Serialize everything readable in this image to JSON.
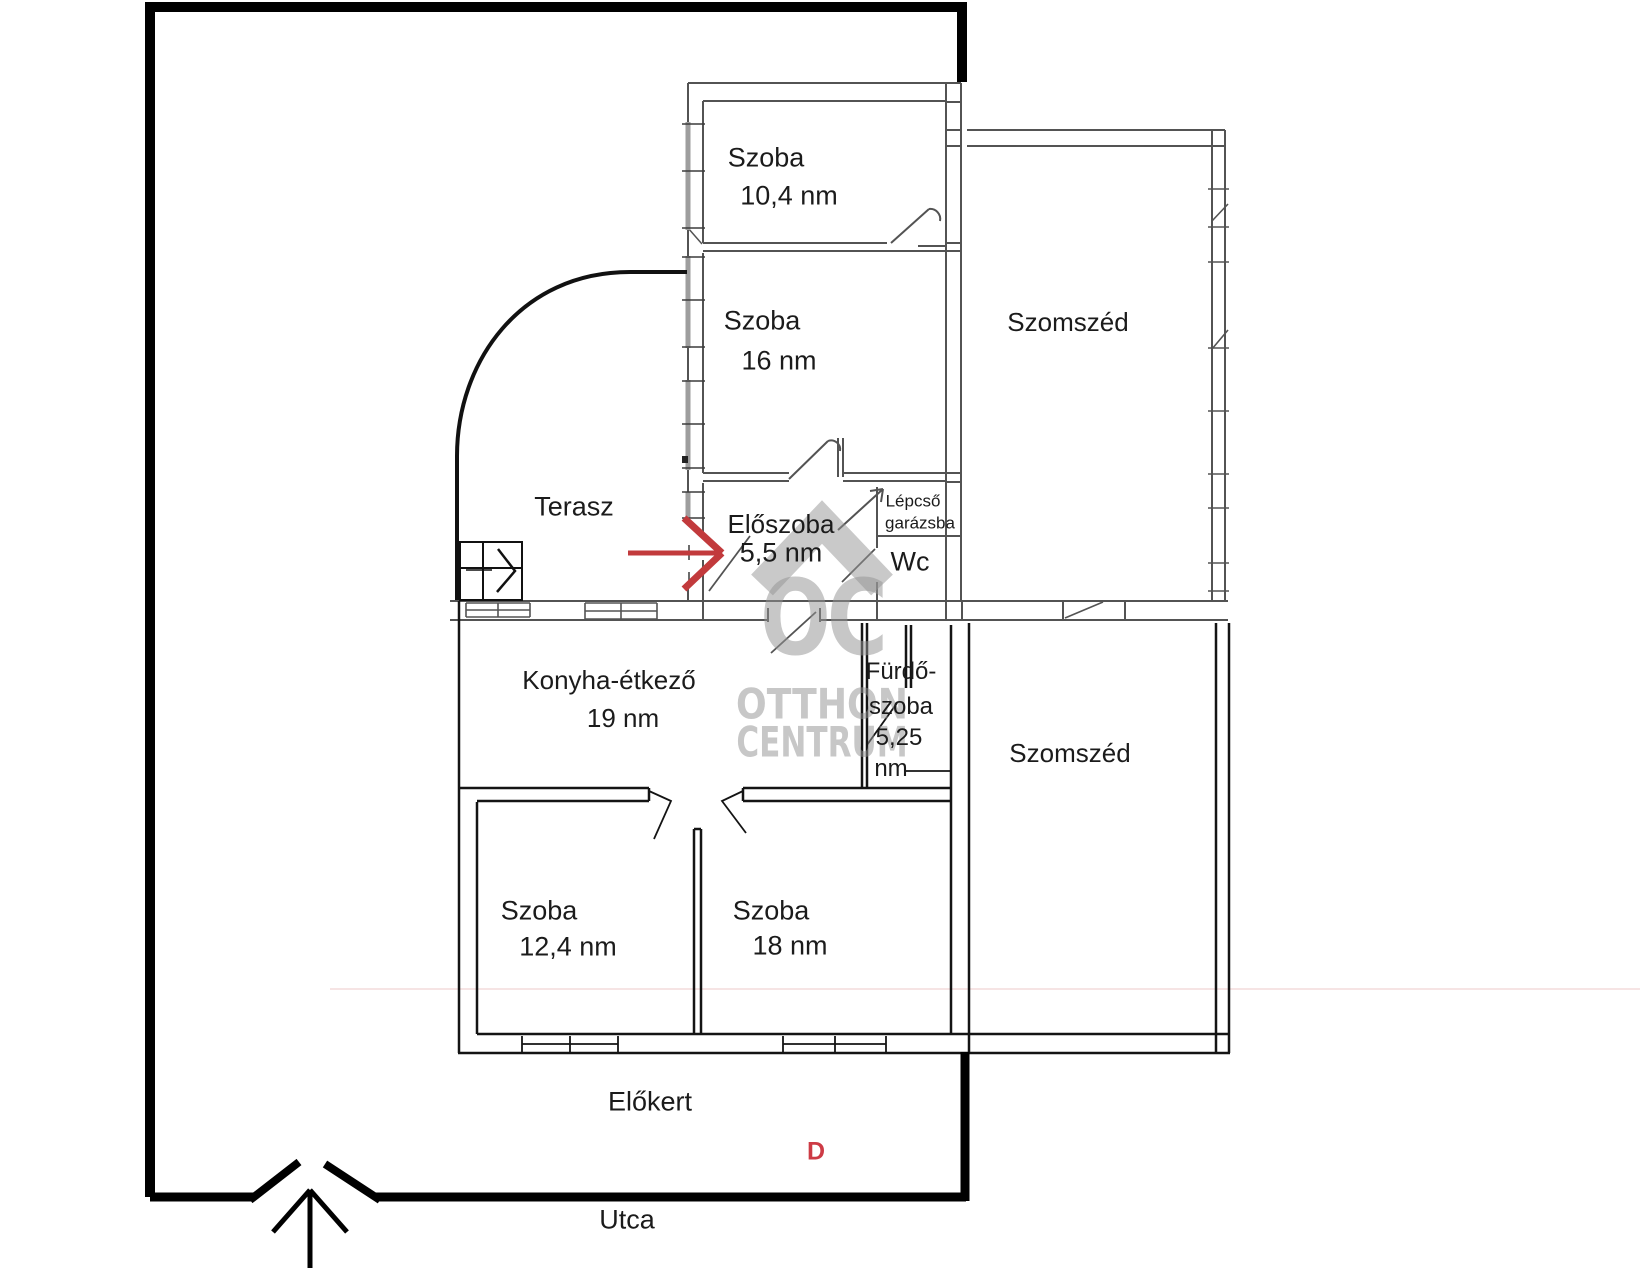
{
  "rooms": {
    "szoba_104": {
      "name": "Szoba",
      "area": "10,4 nm"
    },
    "szoba_16": {
      "name": "Szoba",
      "area": "16 nm"
    },
    "szomszed_upper": {
      "name": "Szomszéd"
    },
    "terasz": {
      "name": "Terasz"
    },
    "eloszoba": {
      "name": "Előszoba",
      "area": "5,5 nm"
    },
    "lepcso": {
      "line1": "Lépcső",
      "line2": "garázsba"
    },
    "wc": {
      "name": "Wc"
    },
    "konyha": {
      "name": "Konyha-étkező",
      "area": "19 nm"
    },
    "furdoszoba": {
      "line1": "Fürdő-",
      "line2": "szoba",
      "line3": "5,25",
      "line4": "nm"
    },
    "szomszed_lower": {
      "name": "Szomszéd"
    },
    "szoba_124": {
      "name": "Szoba",
      "area": "12,4 nm"
    },
    "szoba_18": {
      "name": "Szoba",
      "area": "18 nm"
    }
  },
  "outdoor": {
    "elokert": "Előkert",
    "utca": "Utca",
    "direction_marker": "D"
  },
  "watermark": {
    "logo": "OC",
    "line1": "OTTHON",
    "line2": "CENTRUM"
  },
  "colors": {
    "arrow_red": "#c23a3c",
    "direction_red": "#cd3b45",
    "watermark_gray": "#949494",
    "wall_black": "#141414",
    "scanned_wall_gray": "#454545",
    "boundary_black": "#000000"
  }
}
